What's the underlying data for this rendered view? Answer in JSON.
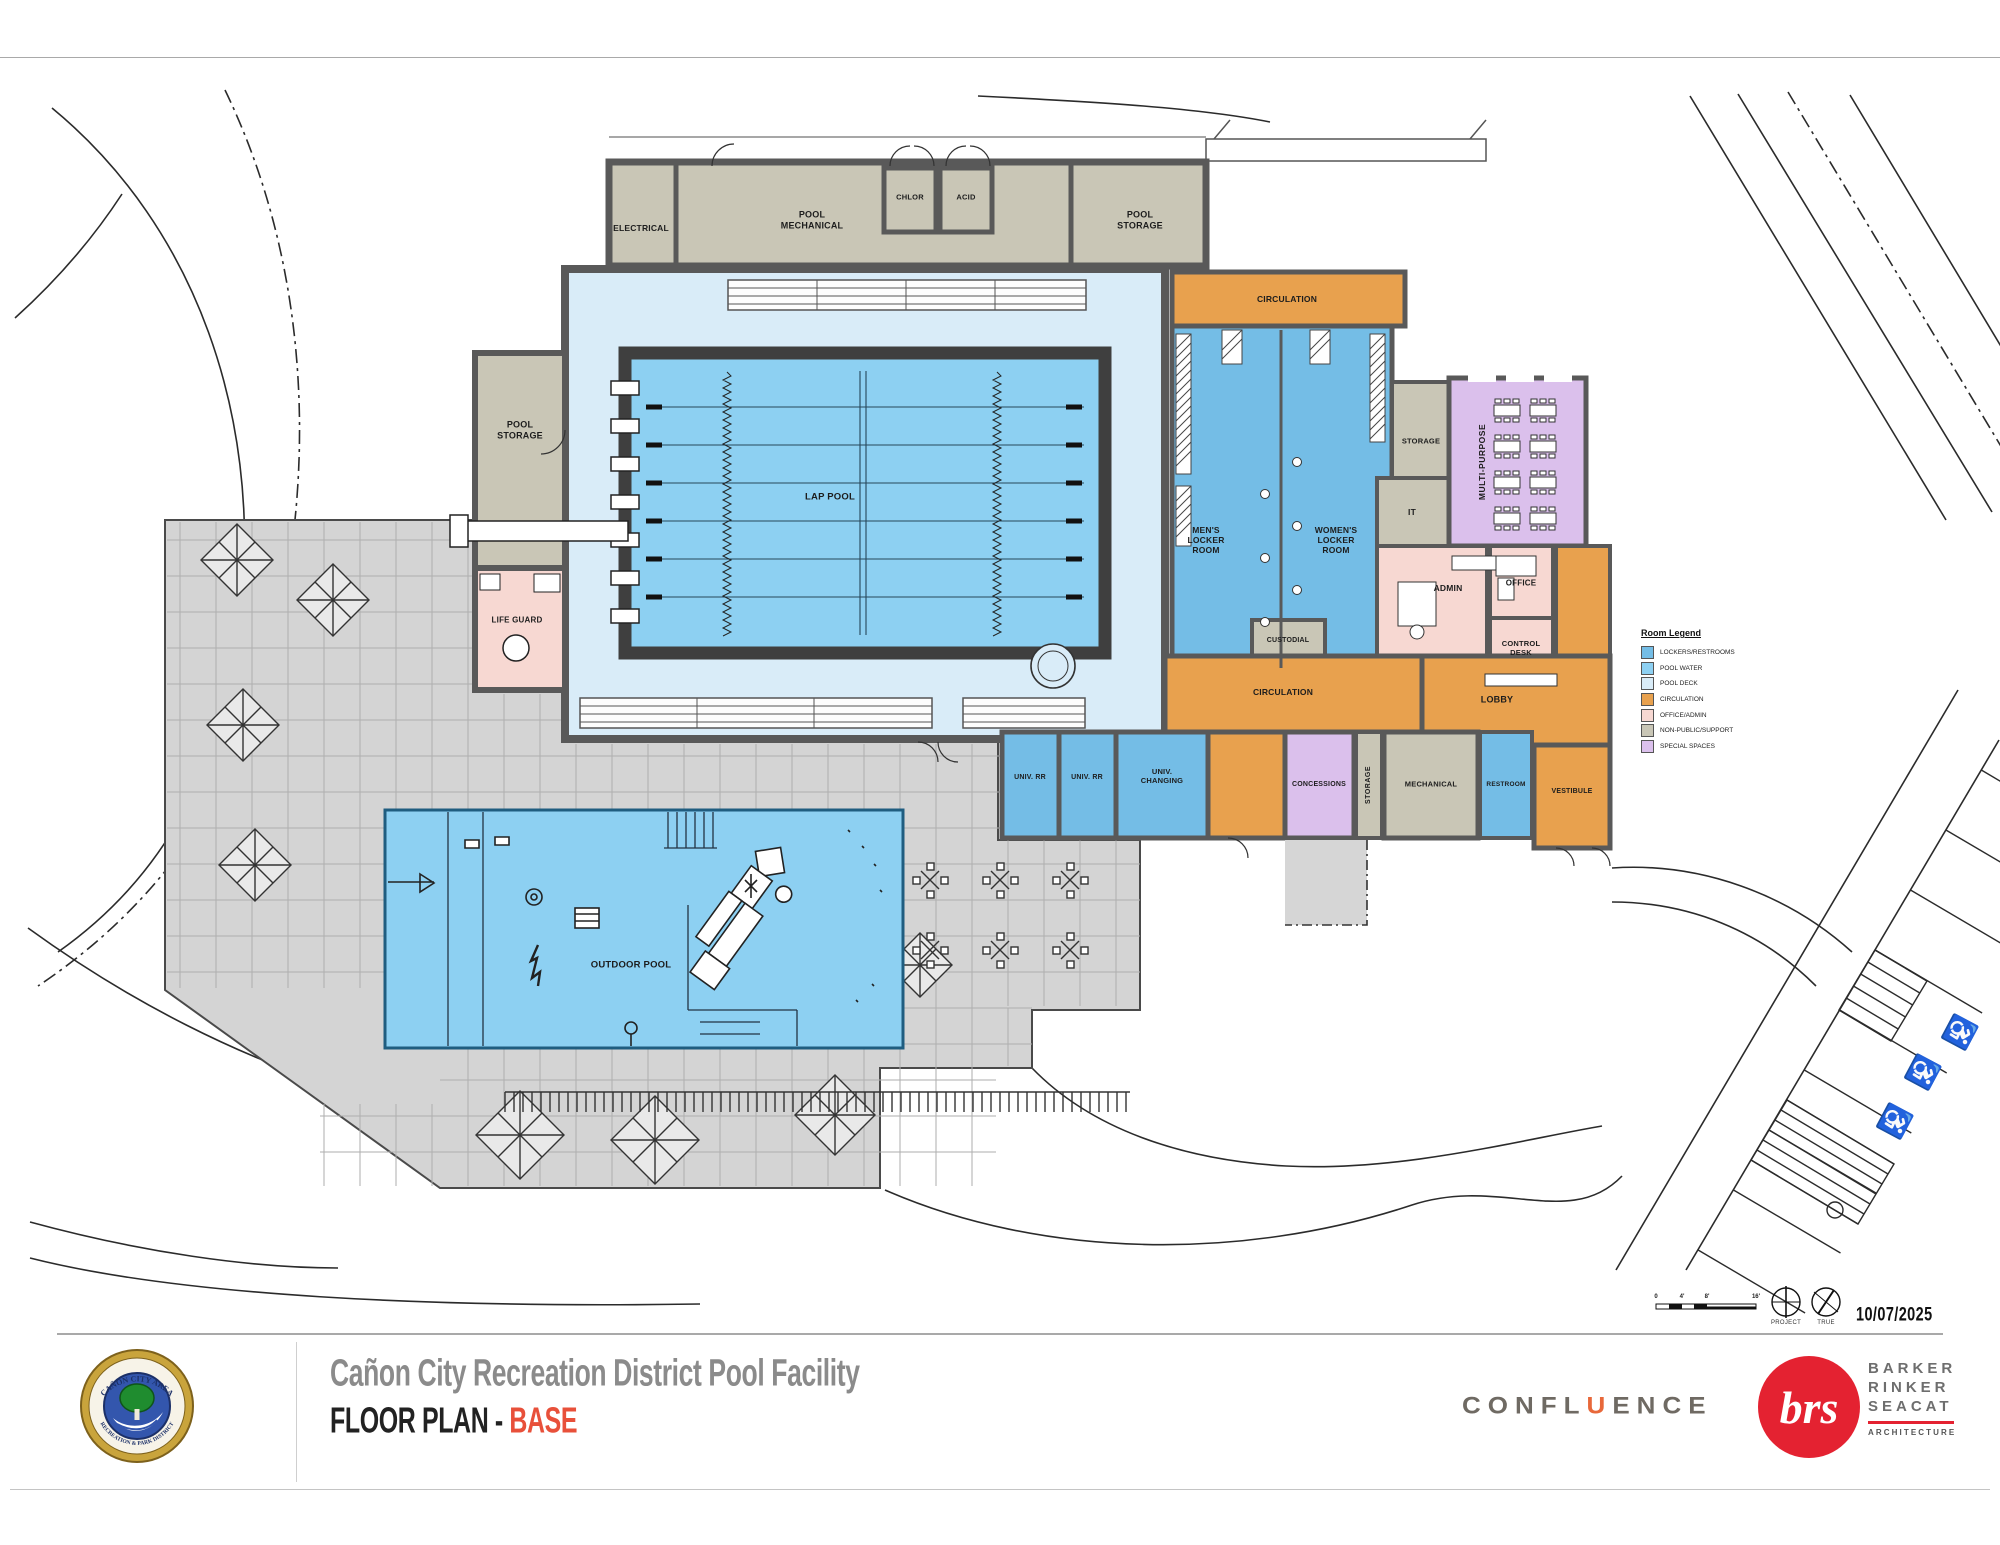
{
  "sheet": {
    "project_title": "Cañon City Recreation District Pool Facility",
    "sheet_title": "FLOOR PLAN",
    "separator": " - ",
    "sheet_variant": "BASE",
    "date": "10/07/2025"
  },
  "rooms": {
    "electrical": "ELECTRICAL",
    "pool_mechanical": "POOL\nMECHANICAL",
    "chlor": "CHLOR",
    "acid": "ACID",
    "pool_storage_top": "POOL\nSTORAGE",
    "pool_storage_west": "POOL\nSTORAGE",
    "life_guard": "LIFE GUARD",
    "lap_pool": "LAP POOL",
    "outdoor_pool": "OUTDOOR POOL",
    "circulation_top": "CIRCULATION",
    "mens_locker": "MEN'S\nLOCKER\nROOM",
    "womens_locker": "WOMEN'S\nLOCKER\nROOM",
    "storage_a": "STORAGE",
    "it": "IT",
    "multipurpose": "MULTI-PURPOSE",
    "admin": "ADMIN",
    "office": "OFFICE",
    "control_desk": "CONTROL\nDESK",
    "custodial": "CUSTODIAL",
    "circulation_mid": "CIRCULATION",
    "lobby": "LOBBY",
    "univ_rr_1": "UNIV. RR",
    "univ_rr_2": "UNIV. RR",
    "univ_changing": "UNIV.\nCHANGING",
    "concessions": "CONCESSIONS",
    "storage_b": "STORAGE",
    "mechanical": "MECHANICAL",
    "restroom": "RESTROOM",
    "vestibule": "VESTIBULE"
  },
  "legend": {
    "title": "Room Legend",
    "items": [
      {
        "label": "LOCKERS/RESTROOMS",
        "color": "#74bde6"
      },
      {
        "label": "POOL WATER",
        "color": "#8dd0f2"
      },
      {
        "label": "POOL DECK",
        "color": "#d9ecf8"
      },
      {
        "label": "CIRCULATION",
        "color": "#e8a14e"
      },
      {
        "label": "OFFICE/ADMIN",
        "color": "#f7d8d2"
      },
      {
        "label": "NON-PUBLIC/SUPPORT",
        "color": "#c9c6b6"
      },
      {
        "label": "SPECIAL SPACES",
        "color": "#dbc0ec"
      }
    ]
  },
  "colors": {
    "lockers": "#74bde6",
    "pool_water": "#8dd0f2",
    "pool_deck": "#d9ecf8",
    "circulation": "#e8a14e",
    "office_admin": "#f7d8d2",
    "support": "#c9c6b6",
    "special": "#dbc0ec",
    "wall": "#595959",
    "deck": "#d4d4d4",
    "deck_grid": "#aeaeae",
    "brand_red": "#e42231",
    "accent_orange": "#e8683a",
    "title_gray": "#8b8b8b"
  },
  "scale": {
    "ticks": [
      "0",
      "4'",
      "8'",
      "16'"
    ]
  },
  "north": {
    "project": "PROJECT",
    "true": "TRUE"
  },
  "seal": {
    "top_text": "CAÑON CITY AREA",
    "bottom_text": "RECREATION & PARK DISTRICT"
  },
  "logos": {
    "confluence_pre": "CONFL",
    "confluence_u": "U",
    "confluence_post": "ENCE",
    "brs_initials": "brs",
    "brs_names": [
      "BARKER",
      "RINKER",
      "SEACAT"
    ],
    "brs_sub": "ARCHITECTURE"
  }
}
